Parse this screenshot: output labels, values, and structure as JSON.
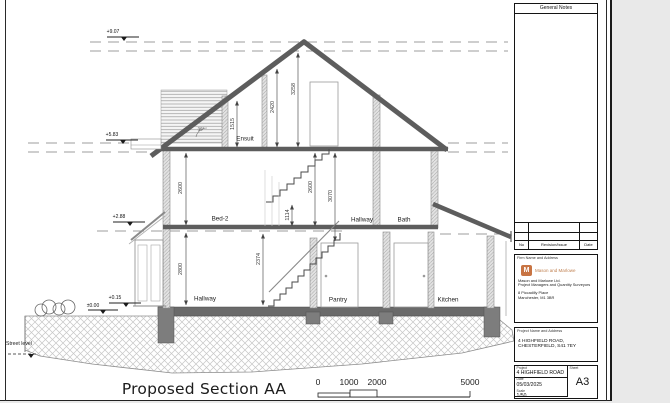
{
  "sheet": {
    "title": "Proposed Section AA",
    "rooms": {
      "ensuite": "Ensuit",
      "bed2": "Bed-2",
      "hallway_first": "Hallway",
      "bath": "Bath",
      "hallway_ground": "Hallway",
      "pantry": "Pantry",
      "kitchen": "Kitchen"
    },
    "dims": {
      "d1515": "1515",
      "d2420": "2420",
      "d3258": "3258",
      "d2600_left": "2600",
      "d2800_left": "2800",
      "d2374": "2374",
      "d2600_stair": "2600",
      "d3070": "3070",
      "d1114": "1114",
      "roof_angle": "35°"
    },
    "levels": {
      "ridge": "+9.07",
      "eaves": "+5.83",
      "first_floor": "+2.88",
      "ground_floor": "+0.15",
      "datum": "±0.00",
      "street": "Street level"
    },
    "scale_bar": {
      "labels": [
        "0",
        "1000",
        "2000",
        "5000"
      ]
    }
  },
  "title_block": {
    "general_notes_title": "General Notes",
    "revision_table": {
      "no": "No",
      "revision": "Revision/Issue",
      "date": "Date"
    },
    "firm": {
      "section_label": "Firm Name and Address",
      "logo_letter": "M",
      "wordmark": "Mason and Marlowe",
      "name": "Mason and Marlowe Ltd.",
      "role": "Project Managers and Quantity Surveyors",
      "address1": "8 Piccadilly Place",
      "address2": "Manchester, M1 3BR",
      "accent_color": "#c87443"
    },
    "project": {
      "section_label": "Project Name and Address",
      "address1": "4 HIGHFIELD ROAD,",
      "address2": "CHESTERFIELD, S41 7EY"
    },
    "info": {
      "project_label": "Project",
      "project_value": "4 HIGHFIELD ROAD",
      "date_label": "Date",
      "date_value": "05/03/2025",
      "scale_label": "Scale",
      "scale_value": "1/50",
      "sheet_label": "Sheet",
      "sheet_value": "A3"
    }
  }
}
